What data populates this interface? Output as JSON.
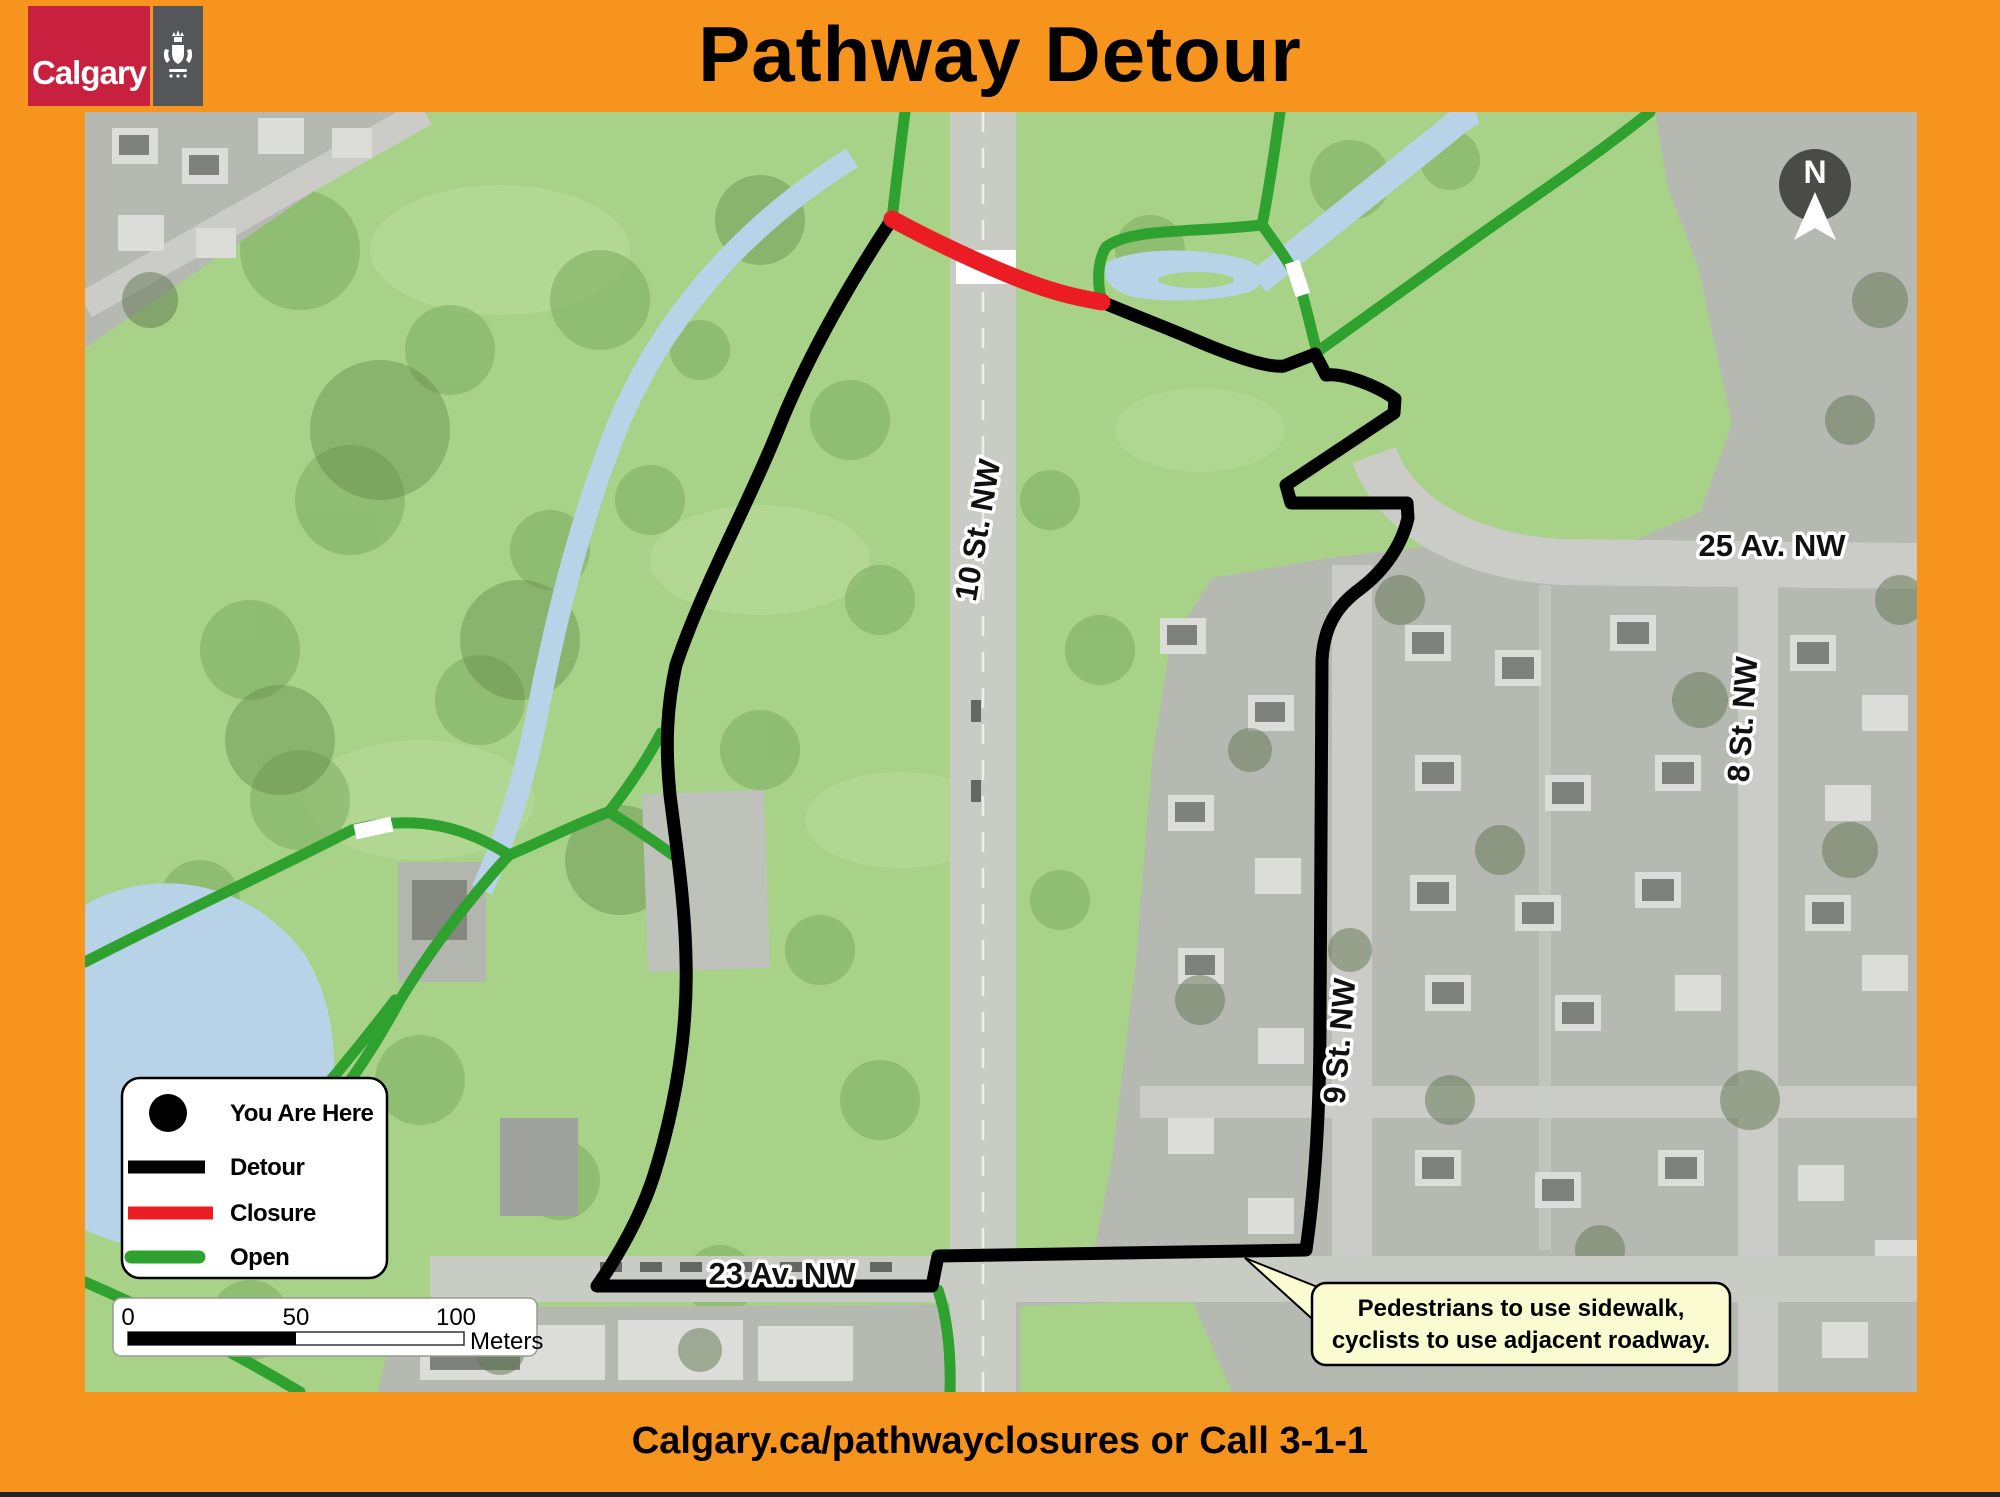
{
  "header": {
    "logo_text": "Calgary",
    "title": "Pathway Detour"
  },
  "map": {
    "north_label": "N",
    "street_labels": {
      "st10": "10 St. NW",
      "st9": "9 St. NW",
      "st8": "8 St. NW",
      "av25": "25 Av. NW",
      "av23": "23 Av. NW"
    },
    "legend": {
      "you_are_here": "You Are Here",
      "detour": "Detour",
      "closure": "Closure",
      "open": "Open"
    },
    "scalebar": {
      "tick0": "0",
      "tick50": "50",
      "tick100": "100",
      "unit": "Meters"
    },
    "callout": {
      "line1": "Pedestrians to use sidewalk,",
      "line2": "cyclists to use adjacent roadway."
    },
    "colors": {
      "frame": "#F7941E",
      "calgary_red": "#C8203F",
      "crest_bg": "#55565A",
      "park": "#A7D287",
      "water": "#B8D3E7",
      "road": "#C9CBC5",
      "residential": "#B6B8B2",
      "open": "#2EA12E",
      "closure": "#EC1C24",
      "detour": "#000000",
      "callout_bg": "#FBFBD2",
      "arrow_bg": "#4A4A47"
    }
  },
  "footer": {
    "text": "Calgary.ca/pathwayclosures or Call 3-1-1"
  }
}
